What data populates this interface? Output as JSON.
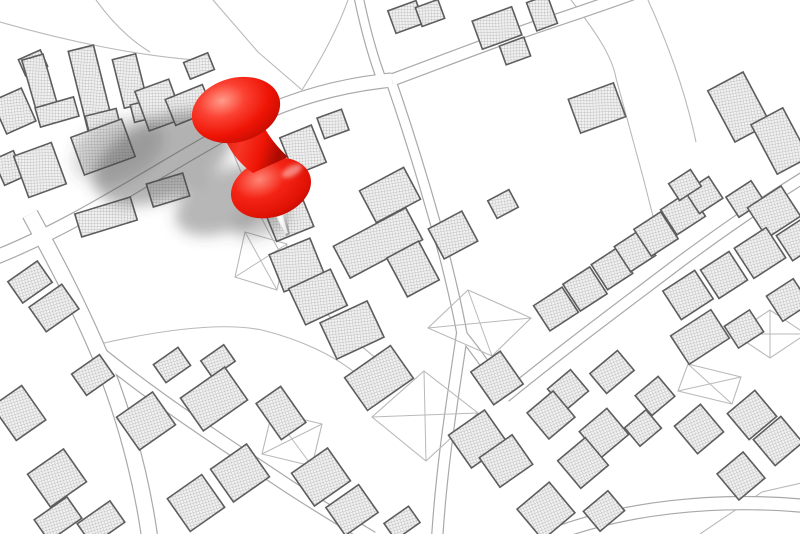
{
  "alt_text": "Black-and-white cadastral city map with hatched building footprints and a large glossy red pushpin stuck into a parcel, casting a soft gray shadow to the lower left",
  "colors": {
    "background": "#ffffff",
    "parcel_line": "#b9b9b9",
    "road_edge": "#a9a9a9",
    "road_fill": "#ffffff",
    "building_outline": "#5d5d5d",
    "hatch_line": "#b3b3b3",
    "hatch_bg": "#f1f1f1",
    "pin_red": "#ee1405",
    "pin_red_dark": "#b80a02",
    "pin_red_mid": "#f42415",
    "pin_highlight": "#ff9c8a",
    "needle_light": "#f5f5f5",
    "needle_dark": "#8f8f8f",
    "shadow": "#4a4a4a"
  },
  "map": {
    "roads": [
      {
        "d": "M -6,258 C 80,224 160,168 238,126 C 282,102 332,86 392,80",
        "w": 13
      },
      {
        "d": "M 392,80 C 446,60 486,44 536,27 C 572,15 602,5 632,-6",
        "w": 11
      },
      {
        "d": "M 384,86 C 373,58 365,28 358,-6",
        "w": 8
      },
      {
        "d": "M 392,84 C 412,142 430,202 446,262 C 452,286 458,312 462,334",
        "w": 9
      },
      {
        "d": "M 462,334 C 454,390 442,460 437,540",
        "w": 10
      },
      {
        "d": "M 30,214 C 56,262 76,300 96,346 C 118,396 140,466 150,540",
        "w": 15
      },
      {
        "d": "M 98,352 C 160,402 222,442 282,482 C 312,502 342,520 372,538",
        "w": 12
      },
      {
        "d": "M 505,397 C 560,352 622,306 680,262 C 722,231 762,203 806,176",
        "w": 10
      },
      {
        "d": "M 540,540 C 620,506 720,498 806,506",
        "w": 12
      },
      {
        "d": "M 462,334 C 480,356 494,376 505,397",
        "w": 8
      }
    ],
    "parcel_lines": [
      "M 213,0 L 258,52 L 302,90",
      "M 96,0 C 112,22 130,40 150,52",
      "M 0,22 C 70,42 140,56 196,60",
      "M 302,90 C 322,58 338,28 348,0",
      "M 571,0 C 596,32 612,56 616,78 L 643,177 L 657,232",
      "M 648,0 C 668,44 686,94 696,142",
      "M 232,150 C 252,200 270,240 298,280 C 322,312 352,340 386,366",
      "M 95,345 C 160,330 222,322 262,330 C 302,340 334,356 354,372",
      "M 700,534 L 762,492 L 806,482",
      "M 763,143 L 806,160"
    ],
    "x_parcels": [
      {
        "points": "424,371 478,413 426,461 372,417"
      },
      {
        "points": "272,412 322,424 312,466 262,454"
      },
      {
        "points": "468,290 531,318 492,356 428,328"
      },
      {
        "points": "245,232 287,244 277,290 235,277"
      },
      {
        "points": "688,364 741,377 732,404 678,391"
      },
      {
        "points": "770,310 806,334 770,358 734,334"
      }
    ],
    "buildings_xywhr": [
      [
        33,
        63,
        24,
        18,
        -24
      ],
      [
        14,
        111,
        32,
        36,
        -24
      ],
      [
        9,
        168,
        22,
        28,
        -24
      ],
      [
        41,
        87,
        22,
        62,
        -16
      ],
      [
        57,
        112,
        40,
        20,
        -16
      ],
      [
        91,
        89,
        26,
        84,
        -14
      ],
      [
        103,
        122,
        32,
        20,
        -14
      ],
      [
        130,
        81,
        24,
        50,
        -14
      ],
      [
        147,
        110,
        30,
        18,
        -14
      ],
      [
        159,
        105,
        36,
        42,
        -20
      ],
      [
        103,
        147,
        54,
        40,
        -20
      ],
      [
        40,
        170,
        40,
        44,
        -20
      ],
      [
        106,
        217,
        58,
        24,
        -17
      ],
      [
        168,
        190,
        38,
        24,
        -17
      ],
      [
        199,
        66,
        26,
        18,
        -22
      ],
      [
        189,
        105,
        40,
        28,
        -22
      ],
      [
        218,
        111,
        26,
        22,
        -22
      ],
      [
        406,
        17,
        30,
        24,
        -20
      ],
      [
        430,
        13,
        24,
        20,
        -20
      ],
      [
        333,
        124,
        26,
        22,
        -20
      ],
      [
        497,
        28,
        42,
        30,
        -20
      ],
      [
        515,
        51,
        26,
        20,
        -20
      ],
      [
        542,
        13,
        22,
        30,
        -20
      ],
      [
        597,
        108,
        48,
        36,
        -20
      ],
      [
        739,
        107,
        40,
        58,
        -28
      ],
      [
        780,
        141,
        36,
        56,
        -28
      ],
      [
        303,
        150,
        34,
        40,
        -22
      ],
      [
        290,
        221,
        40,
        28,
        -22
      ],
      [
        297,
        265,
        44,
        40,
        -22
      ],
      [
        390,
        195,
        50,
        36,
        -28
      ],
      [
        378,
        243,
        82,
        36,
        -28
      ],
      [
        413,
        269,
        36,
        44,
        -28
      ],
      [
        453,
        235,
        38,
        34,
        -28
      ],
      [
        503,
        204,
        24,
        20,
        -28
      ],
      [
        318,
        297,
        46,
        40,
        -25
      ],
      [
        352,
        330,
        52,
        40,
        -25
      ],
      [
        556,
        309,
        34,
        30,
        -33
      ],
      [
        585,
        289,
        32,
        32,
        -33
      ],
      [
        612,
        269,
        30,
        30,
        -33
      ],
      [
        635,
        251,
        30,
        30,
        -33
      ],
      [
        656,
        234,
        32,
        32,
        -33
      ],
      [
        683,
        213,
        34,
        30,
        -33
      ],
      [
        704,
        195,
        28,
        26,
        -33
      ],
      [
        685,
        185,
        26,
        20,
        -33
      ],
      [
        745,
        199,
        30,
        24,
        -33
      ],
      [
        774,
        212,
        40,
        36,
        -33
      ],
      [
        797,
        240,
        30,
        30,
        -33
      ],
      [
        688,
        295,
        38,
        34,
        -33
      ],
      [
        724,
        275,
        34,
        34,
        -33
      ],
      [
        760,
        253,
        38,
        36,
        -33
      ],
      [
        700,
        337,
        48,
        34,
        -33
      ],
      [
        744,
        329,
        30,
        26,
        -33
      ],
      [
        788,
        300,
        32,
        30,
        -33
      ],
      [
        93,
        375,
        34,
        26,
        -35
      ],
      [
        172,
        365,
        30,
        22,
        -35
      ],
      [
        218,
        361,
        28,
        20,
        -35
      ],
      [
        214,
        399,
        54,
        40,
        -35
      ],
      [
        146,
        421,
        44,
        40,
        -35
      ],
      [
        19,
        413,
        36,
        42,
        -35
      ],
      [
        30,
        282,
        36,
        26,
        -35
      ],
      [
        54,
        308,
        40,
        30,
        -35
      ],
      [
        57,
        478,
        44,
        40,
        -35
      ],
      [
        58,
        519,
        40,
        26,
        -35
      ],
      [
        101,
        523,
        40,
        26,
        -35
      ],
      [
        196,
        503,
        42,
        40,
        -35
      ],
      [
        240,
        473,
        44,
        40,
        -35
      ],
      [
        281,
        413,
        30,
        44,
        -35
      ],
      [
        321,
        477,
        44,
        40,
        -35
      ],
      [
        352,
        510,
        40,
        34,
        -35
      ],
      [
        402,
        523,
        30,
        20,
        -35
      ],
      [
        379,
        378,
        56,
        40,
        -35
      ],
      [
        497,
        378,
        36,
        40,
        -35
      ],
      [
        478,
        439,
        44,
        40,
        -35
      ],
      [
        506,
        461,
        40,
        36,
        -35
      ],
      [
        612,
        372,
        36,
        26,
        -40
      ],
      [
        568,
        390,
        30,
        28,
        -40
      ],
      [
        551,
        415,
        34,
        34,
        -40
      ],
      [
        655,
        396,
        30,
        26,
        -40
      ],
      [
        604,
        433,
        36,
        34,
        -40
      ],
      [
        643,
        428,
        28,
        24,
        -40
      ],
      [
        583,
        463,
        36,
        36,
        -40
      ],
      [
        699,
        429,
        34,
        36,
        -40
      ],
      [
        752,
        415,
        36,
        34,
        -40
      ],
      [
        778,
        441,
        36,
        34,
        -40
      ],
      [
        741,
        476,
        34,
        34,
        -40
      ],
      [
        546,
        511,
        42,
        40,
        -40
      ],
      [
        604,
        511,
        32,
        26,
        -40
      ]
    ]
  },
  "pin": {
    "shadow": [
      {
        "cx": 163,
        "cy": 158,
        "rx": 74,
        "ry": 40,
        "rot": -24,
        "o": 0.42
      },
      {
        "cx": 228,
        "cy": 200,
        "rx": 56,
        "ry": 30,
        "rot": -24,
        "o": 0.4
      },
      {
        "cx": 118,
        "cy": 150,
        "rx": 48,
        "ry": 30,
        "rot": -24,
        "o": 0.22
      },
      {
        "cx": 262,
        "cy": 222,
        "rx": 30,
        "ry": 14,
        "rot": -20,
        "o": 0.3
      }
    ],
    "needle_points": "265,194 280,190 290,234 286,236",
    "needle_highlight_points": "270,195 275,193 288,233 285,234",
    "flange": {
      "cx": 271,
      "cy": 188,
      "rx": 41,
      "ry": 29,
      "rot": -18
    },
    "flange_highlight": {
      "cx": 292,
      "cy": 171,
      "rx": 11,
      "ry": 5,
      "rot": -28
    },
    "stem_path": "M 219,123 C 226,147 238,163 253,173 L 288,157 C 273,143 261,127 255,104 Z",
    "head": {
      "cx": 236,
      "cy": 110,
      "rx": 45,
      "ry": 32,
      "rot": -16
    }
  }
}
